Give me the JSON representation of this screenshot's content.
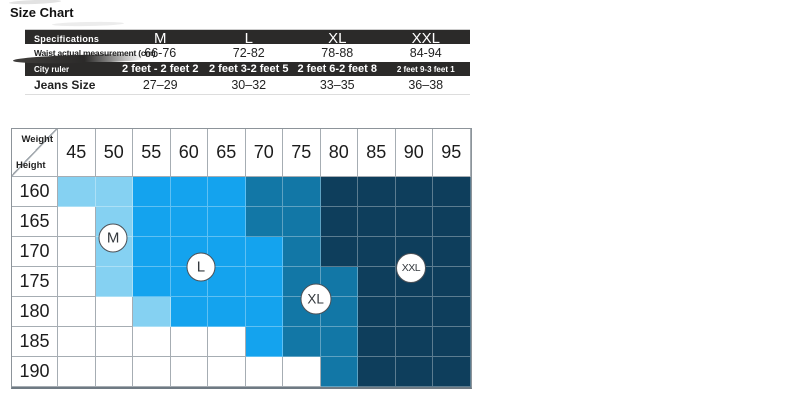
{
  "page_title": "Size Chart",
  "colors": {
    "table_dark_row_bg": "#2b2a29",
    "size_m": "#85d1f2",
    "size_l": "#14a3ee",
    "size_xl": "#1277a6",
    "size_xxl": "#0e3e5c"
  },
  "spec_table": {
    "header": {
      "label": "Specifications",
      "columns": [
        "M",
        "L",
        "XL",
        "XXL"
      ]
    },
    "rows": [
      {
        "label": "Waist actual measurement (cm)",
        "style": "light",
        "values": [
          "66-76",
          "72-82",
          "78-88",
          "84-94"
        ]
      },
      {
        "label": "City ruler",
        "style": "dark",
        "values": [
          "2 feet - 2 feet 2",
          "2 feet 3-2 feet 5",
          "2 feet 6-2 feet 8",
          "2 feet 9-3 feet 1"
        ]
      },
      {
        "label": "Jeans Size",
        "style": "light",
        "values": [
          "27–29",
          "30–32",
          "33–35",
          "36–38"
        ]
      }
    ]
  },
  "chart_data": {
    "type": "heatmap",
    "xlabel": "Weight",
    "ylabel": "Height",
    "x": [
      45,
      50,
      55,
      60,
      65,
      70,
      75,
      80,
      85,
      90,
      95
    ],
    "y": [
      160,
      165,
      170,
      175,
      180,
      185,
      190
    ],
    "cells": [
      [
        "M",
        "M",
        "L",
        "L",
        "L",
        "XL",
        "XL",
        "XXL",
        "XXL",
        "XXL",
        "XXL"
      ],
      [
        "",
        "M",
        "L",
        "L",
        "L",
        "XL",
        "XL",
        "XXL",
        "XXL",
        "XXL",
        "XXL"
      ],
      [
        "",
        "M",
        "L",
        "L",
        "L",
        "L",
        "XL",
        "XXL",
        "XXL",
        "XXL",
        "XXL"
      ],
      [
        "",
        "M",
        "L",
        "L",
        "L",
        "L",
        "XL",
        "XL",
        "XXL",
        "XXL",
        "XXL"
      ],
      [
        "",
        "",
        "M",
        "L",
        "L",
        "L",
        "XL",
        "XL",
        "XXL",
        "XXL",
        "XXL"
      ],
      [
        "",
        "",
        "",
        "",
        "",
        "L",
        "XL",
        "XL",
        "XXL",
        "XXL",
        "XXL"
      ],
      [
        "",
        "",
        "",
        "",
        "",
        "",
        "",
        "XL",
        "XXL",
        "XXL",
        "XXL"
      ]
    ],
    "colors": {
      "M": "#85d1f2",
      "L": "#14a3ee",
      "XL": "#1277a6",
      "XXL": "#0e3e5c",
      "": "#ffffff"
    },
    "markers": [
      {
        "label": "M",
        "cx": 1.47,
        "cy": 2.03
      },
      {
        "label": "L",
        "cx": 3.81,
        "cy": 3.0
      },
      {
        "label": "XL",
        "cx": 6.87,
        "cy": 4.07
      },
      {
        "label": "XXL",
        "cx": 9.41,
        "cy": 3.03
      }
    ],
    "layout": {
      "legend": false,
      "grid": true
    }
  }
}
